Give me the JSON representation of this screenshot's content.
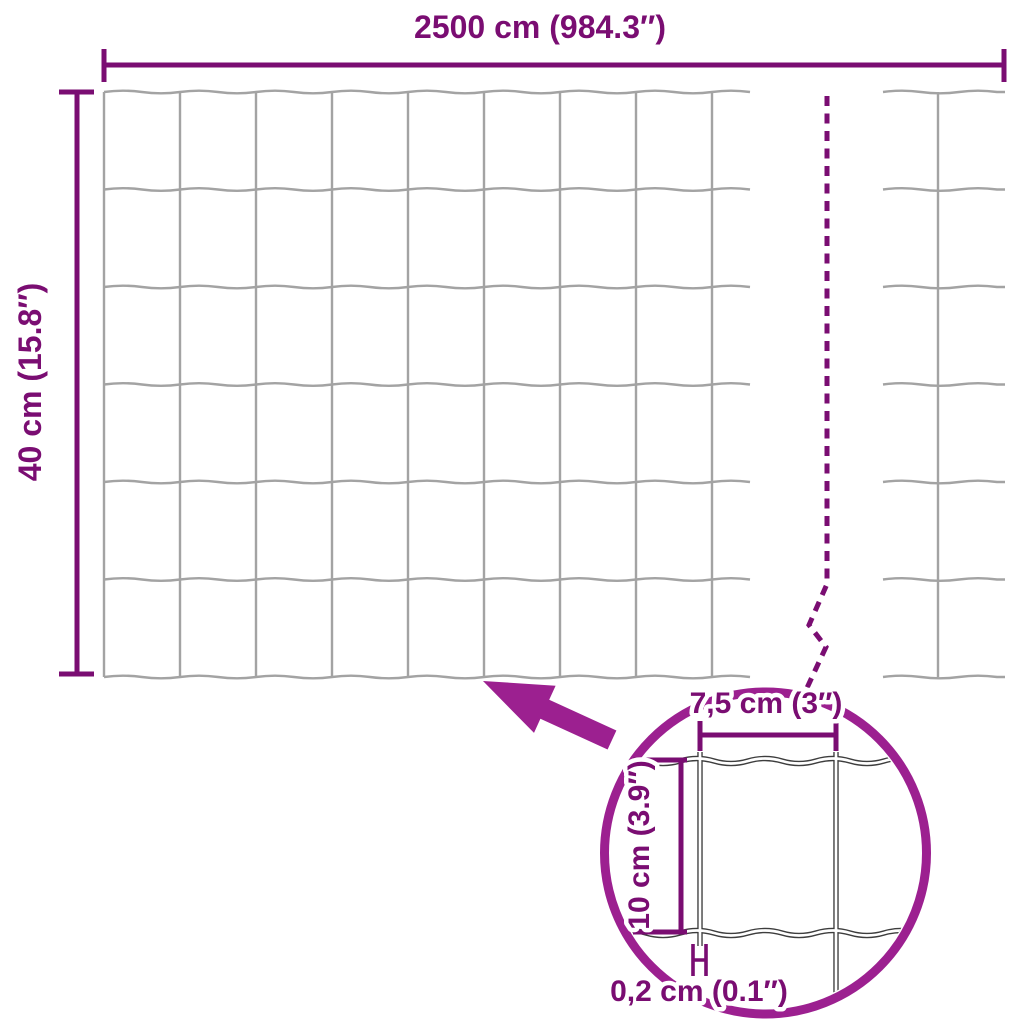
{
  "colors": {
    "dimension": "#7a0d72",
    "accent": "#9c2090",
    "wire": "#a3a3a3",
    "detail_wire": "#3d3d3d",
    "background": "#ffffff"
  },
  "labels": {
    "total_width": "2500 cm (984.3″)",
    "total_height": "40 cm (15.8″)",
    "detail_cell_width": "7,5 cm (3″)",
    "detail_cell_height": "10 cm (3.9″)",
    "detail_wire_thickness": "0,2 cm (0.1″)"
  }
}
